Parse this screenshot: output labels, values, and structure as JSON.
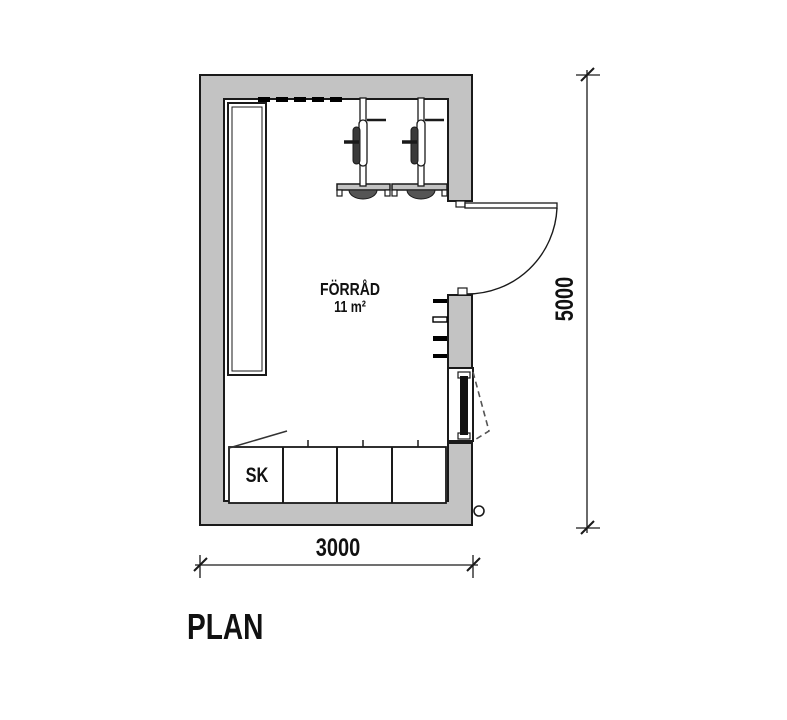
{
  "canvas": {
    "background": "#ffffff",
    "wall_fill": "#c3c3c3",
    "line_color": "#1a1a1a",
    "text_color": "#111111"
  },
  "plan": {
    "title": "PLAN",
    "room": {
      "name": "FÖRRÅD",
      "area": "11 m²"
    },
    "cabinet_label": "SK",
    "dim_width": "3000",
    "dim_height": "5000"
  }
}
